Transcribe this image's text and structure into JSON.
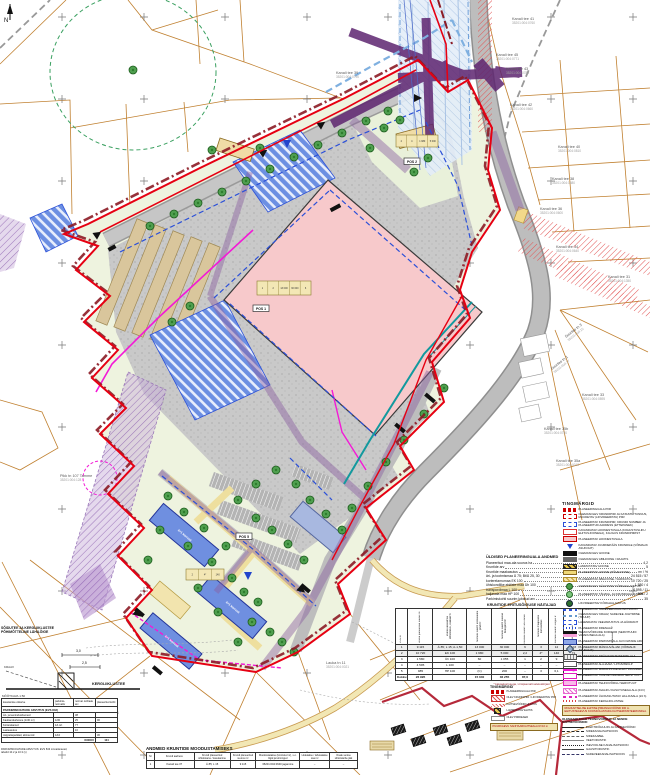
{
  "map": {
    "north_label": "N",
    "parcels": [
      {
        "n": "Kanali tee 41",
        "c": "35201:004:0760",
        "x": 512,
        "y": 20
      },
      {
        "n": "Kanali tee 45",
        "c": "35201:004:0771",
        "x": 496,
        "y": 56
      },
      {
        "n": "Kanali tee 43",
        "c": "35201:004:0780",
        "x": 506,
        "y": 70
      },
      {
        "n": "Kanali tee 42",
        "c": "35201:004:0660",
        "x": 510,
        "y": 106
      },
      {
        "n": "Kanali tee 40",
        "c": "35201:004:0810",
        "x": 558,
        "y": 148
      },
      {
        "n": "Kanali tee 38",
        "c": "35201:004:1580",
        "x": 552,
        "y": 180
      },
      {
        "n": "Kanali tee 36",
        "c": "35201:004:0600",
        "x": 540,
        "y": 210
      },
      {
        "n": "Kanali tee 34",
        "c": "35201:004:0640",
        "x": 556,
        "y": 248
      },
      {
        "n": "Kanali tee 31",
        "c": "35201:004:1350",
        "x": 608,
        "y": 278
      },
      {
        "n": "Kanali tee 33",
        "c": "35201:004:0895",
        "x": 582,
        "y": 396
      },
      {
        "n": "Kanali tee 35b",
        "c": "35201:004:0750",
        "x": 544,
        "y": 430
      },
      {
        "n": "Kanali tee 35a",
        "c": "35201:004:0013",
        "x": 556,
        "y": 462
      },
      {
        "n": "Kanali tee 39",
        "c": "35201:004:0790",
        "x": 336,
        "y": 74
      },
      {
        "n": "Suurtee tn 3",
        "c": "35201:004:15",
        "x": 566,
        "y": 338,
        "rot": -38
      },
      {
        "n": "Suurtee tn 1",
        "c": "35201:004:17",
        "x": 552,
        "y": 370,
        "rot": -38
      },
      {
        "n": "Pikk tn 107 Tamme",
        "c": "35201:004:128",
        "x": 60,
        "y": 477
      },
      {
        "n": "Lauka tn 11",
        "c": "35201:004:0021",
        "x": 326,
        "y": 664
      },
      {
        "n": "Nuka",
        "c": "35201:004:0041",
        "x": 96,
        "y": 710
      }
    ],
    "pos_boxes": [
      {
        "t": "POS 1",
        "x": 253,
        "y": 305
      },
      {
        "t": "POS 2",
        "x": 404,
        "y": 158
      },
      {
        "t": "POS 5",
        "x": 236,
        "y": 533
      }
    ],
    "plates": [
      {
        "x": 257,
        "y": 281,
        "w": 54,
        "h": 14,
        "cells": [
          "1",
          "2",
          "13 000",
          "30 000",
          "6"
        ]
      },
      {
        "x": 396,
        "y": 135,
        "w": 42,
        "h": 12,
        "cells": [
          "2",
          "4",
          "1 980",
          "5 000"
        ]
      },
      {
        "x": 186,
        "y": 569,
        "w": 38,
        "h": 11,
        "cells": [
          "2",
          "4*",
          "140"
        ]
      }
    ],
    "building_labels": [
      {
        "t": "4+1 korrust",
        "x": 184,
        "y": 536,
        "rot": 40
      },
      {
        "t": "4+1 korrust",
        "x": 232,
        "y": 608,
        "rot": 40
      },
      {
        "t": "4+1 korrust",
        "x": 171,
        "y": 642,
        "rot": 40
      }
    ]
  },
  "section": {
    "line1": "SÕIDUTEE JA KERGLIIKLUSTEE",
    "line2": "PÕHIMÕTTELINE LÄHILÕIGE",
    "dim1": "3,0",
    "dim2": "2,5",
    "side_label": "KRAAV",
    "ground_label": "KERGLIIKLUSTEE",
    "scale": "MÕÕTKAVA 1:50"
  },
  "general": {
    "title": "ÜLDISED PLANEERINGUALA ANDMED",
    "rows": [
      {
        "l": "Planeeritud maa-ala suurus ha",
        "v": "4,2"
      },
      {
        "l": "Kruntide arv",
        "v": "5"
      },
      {
        "l": "Kruntide maakasutus",
        "v": "m²  /  %"
      },
      {
        "l": "äri- ja tootmismaa Ä 75; Bt/Ä 25, 30",
        "v": "24 515 / 57"
      },
      {
        "l": "korterelamumaa EK 100",
        "v": "10 720 / 25"
      },
      {
        "l": "ühiskondlike ehitiste maa Üh 100",
        "v": "1 580 / 4"
      },
      {
        "l": "transpordimaa L 100",
        "v": "4 595 / 11"
      },
      {
        "l": "haljasala maa HP 100",
        "v": "985 / 2"
      },
      {
        "l": "Parkimiskohti suurim lubatud arv",
        "v": "35"
      }
    ]
  },
  "rights": {
    "title": "KRUNTIDE EHITUSÕIGUSE NÄITAJAD",
    "headers": [
      "POS nr",
      "krundi planeeritud suurus m²",
      "krundi kasutamise sihtotstarve, osakaal %",
      "hoonete suurim ehitisealune pind m²",
      "hoonete suurim suletud brutopind m²",
      "hoonete suurim arv krundil",
      "hoonete maapealne korruselisus",
      "hoonete suurim kõrgus m",
      "parkimiskohtade arv",
      "märkused"
    ],
    "rows": [
      [
        "1",
        "9 115",
        "Ä 85; L 15; A-1,50",
        "13 000",
        "30 000",
        "6",
        "3",
        "12",
        "103",
        ""
      ],
      [
        "2",
        "10 720",
        "EK 100",
        "1 980",
        "5 000",
        "2,2",
        "4*",
        "140",
        "71",
        ""
      ],
      [
        "3",
        "1 580",
        "Üh 100",
        "60",
        "1 055",
        "1",
        "2",
        "9",
        "32",
        ""
      ],
      [
        "4",
        "4 595",
        "L 100",
        "–",
        "–",
        "–",
        "–",
        "–",
        "–",
        ""
      ],
      [
        "5",
        "985",
        "HP 100",
        "(C)",
        "200",
        "–",
        "3",
        "6,1",
        "–",
        ""
      ]
    ],
    "total": [
      "Kokku",
      "26 995",
      "",
      "15 040",
      "36 255",
      "87,6",
      "",
      "",
      "206",
      ""
    ],
    "footnote": "* katusekorrusega, vt täpsemalt seletuskirjast"
  },
  "formation": {
    "title": "ANDMED KRUNTIDE MOODUSTAMISEKS",
    "headers": [
      "Nr",
      "Krundi aadress",
      "Krundi planeeritud sihtotstarve / kasutamine",
      "Krundi planeeritud suurus m²",
      "Moodustatakse (kinnistud nr), s.o. liigid ja toimingud",
      "Liidetakse / lahutatakse osa m²",
      "Osale senise sihtotstarbe jätk"
    ],
    "row": [
      "1",
      "Kanali tee 37",
      "Ä 85; L 15",
      "9 115",
      "35201:004:0640 jagamine",
      "–",
      "–"
    ]
  },
  "parking": {
    "title": "PARKIMISKOHTADE ARVUTUS (EVS 843)",
    "headers": [
      "kasutamise otstarve",
      "parkimis- normatiiv",
      "normat. kohtade arv",
      "planeeritud kohti"
    ],
    "rows": [
      [
        "Äri- ja teenindushooned",
        "",
        "38",
        ""
      ],
      [
        "Kaubandushoone (1/30 m²)",
        "1/30",
        "25",
        "96"
      ],
      [
        "Korterelamud",
        "1/1 krt",
        "77",
        ""
      ],
      [
        "Lasteasutus",
        "",
        "10",
        ""
      ],
      [
        "Jalgrattaparklad, abiruumid",
        "1/10",
        "",
        "30"
      ]
    ],
    "total_label": "KOKKU",
    "total_value": "124",
    "footnote1": "PARKIMISKOHTADE ARVUTUS: EVS 843 Linnatänavad,",
    "footnote2": "tabelid 10.2 ja 10.3 (v)"
  },
  "legend": {
    "title": "TINGMÄRGID",
    "entries": [
      {
        "t": "boundary",
        "l": "PLANEERINGUALA PIIR"
      },
      {
        "t": "krunt",
        "l": "OLEMASOLEV KRUNDIPIIR JA KATASTRITUNNUS, MUUDETAV (LIKVIDEERITAV) PIIR"
      },
      {
        "t": "bluedash_box",
        "l": "PLANEERITAV KRUNDIPIIR, KRUNDI NUMBER JA PLANEERITUD AADRESS (ETTEPANEK)"
      },
      {
        "t": "whitered",
        "l": "KAVANDATAV HOONESTUSALA (KOHUSTUSLIKU EHITUSJOONEGA), KAUGUS KRUNDIPIIRIST"
      },
      {
        "t": "redfill",
        "l": "PLANEERITAV HOONESTUSALA"
      },
      {
        "t": "bluearrow",
        "l": "KAVANDATAV JUURDEPÄÄS KRUNDILE (VÕIMALIK ASUKOHT)"
      },
      {
        "t": "blackbar",
        "l": "OLEMASOLEV HOONE"
      },
      {
        "t": "graybar",
        "l": "OLEMASOLEV ABIHOONE / RAJATIS"
      },
      {
        "t": "yelblack",
        "l": "LAMMUTATAV HOONE"
      },
      {
        "t": "yellow",
        "l": "PLANEERITAV HOONE (PÕHIHOONE)"
      },
      {
        "t": "yelhatch",
        "l": "PLANEERITAV ABIHOONE / VARIKATUS"
      },
      {
        "t": "tree",
        "l": "OLEMASOLEV SÄILITATAV KÕRGHALJASTUS"
      },
      {
        "t": "treerow",
        "l": "PLANEERITAV TÄNAVA- JA KRUNDIHALJASTUS"
      },
      {
        "t": "treex",
        "l": "LIKVIDEERITAV KÕRGHALJASTUS"
      },
      {
        "t": "bdash",
        "l": "PLANEERITAV SADEVEEKANALISATSIOON"
      },
      {
        "t": "bdash2",
        "l": "OLEMASOLEV KRAAV, SADEVEE JUHTIMINE (TRUUP)"
      },
      {
        "t": "bsq",
        "l": "LAHENDATAV VEEVARUSTUS JA HÜDRANT"
      },
      {
        "t": "bdash3",
        "l": "PLANEERITAV DRENAAŽ"
      },
      {
        "t": "blackpink",
        "l": "TEHNOVÕRKUDE KORIDOR (SERVITUUDI VAJADUSEGA ALA)"
      },
      {
        "t": "bluebox",
        "l": "PLANEERITAV PARKIMISALA JA KOHTADE ARV"
      },
      {
        "t": "diamond",
        "l": "PLANEERITAV MÄNGUVÄLJAK (VÕIMALIK ASUKOHT)"
      },
      {
        "t": "gridbox",
        "l": "PLANEERITAV PRÜGIKONTEINERITE ALA"
      },
      {
        "t": "ehbox",
        "l": "PLANEERITAV ALAJAAM / LIITUMISKILP"
      },
      {
        "t": "magline",
        "l": "PLANEERITAV MADALPINGE ELEKTRIKAABEL"
      },
      {
        "t": "magbox",
        "l": "PLANEERITAV TRANSPORDIMAA SERVITUUT"
      },
      {
        "t": "magbox2",
        "l": "PLANEERITAV TEHNOVÕRGU SERVITUUT"
      },
      {
        "t": "maghatch",
        "l": "PLANEERITAV AVALIKU KASUTUSEGA ALA (24 h)"
      },
      {
        "t": "magdash",
        "l": "PLANEERITAV ÜLDKASUTATAV HALJASALA (24 h)"
      },
      {
        "t": "reddots",
        "l": "PLANEERITAV KERGLIIKLUSTEE"
      }
    ],
    "note": [
      "RIIGIKAITSELISE EHITISE PIIRANGUVÖÖND 300 m.",
      "EHITUSTEGEVUS KOOSKÕLASTADA KAITSEMINISTEERIUMIGA."
    ],
    "sub": "OLEMASOLEVAD TEHNOVÕRGUD JA NENDE KAITSEVÖÖNDID:",
    "lines": [
      "ELEKTRIÕHULIIN JA KAITSEVÖÖND",
      "SIDEKANALISATSIOON",
      "SIDEKAABEL",
      "VEETORUSTIK",
      "ISEVOOLNE KANALISATSIOON",
      "GAASITORUSTIK",
      "SADEVEEKANALISATSIOON"
    ]
  },
  "minileg": {
    "title": "TINGMÄRGID",
    "entries": [
      {
        "t": "boundary",
        "l": "PLANEERINGUALA PIIR"
      },
      {
        "t": "redhatchw",
        "l": "OLEV KRUNDIPIIR / LI­KVIDEERITAV PIIR"
      },
      {
        "t": "redhatchs",
        "l": "KAITSEVÖÖNDI ULATUS"
      },
      {
        "t": "yelblack_sm",
        "l": "LAMMUTATAV EHITIS"
      },
      {
        "t": "whitepair",
        "l": "OLEV PIIRDEAED"
      }
    ],
    "note": [
      "PUURKAEVU SANITAARKAITSEALA R=10 m"
    ]
  },
  "colors": {
    "boundary_red": "#e60012",
    "boundary_dark": "#8c1b25",
    "building_pink": "#f7c9cb",
    "magenta": "#f319d6",
    "teal": "#12999e"
  }
}
